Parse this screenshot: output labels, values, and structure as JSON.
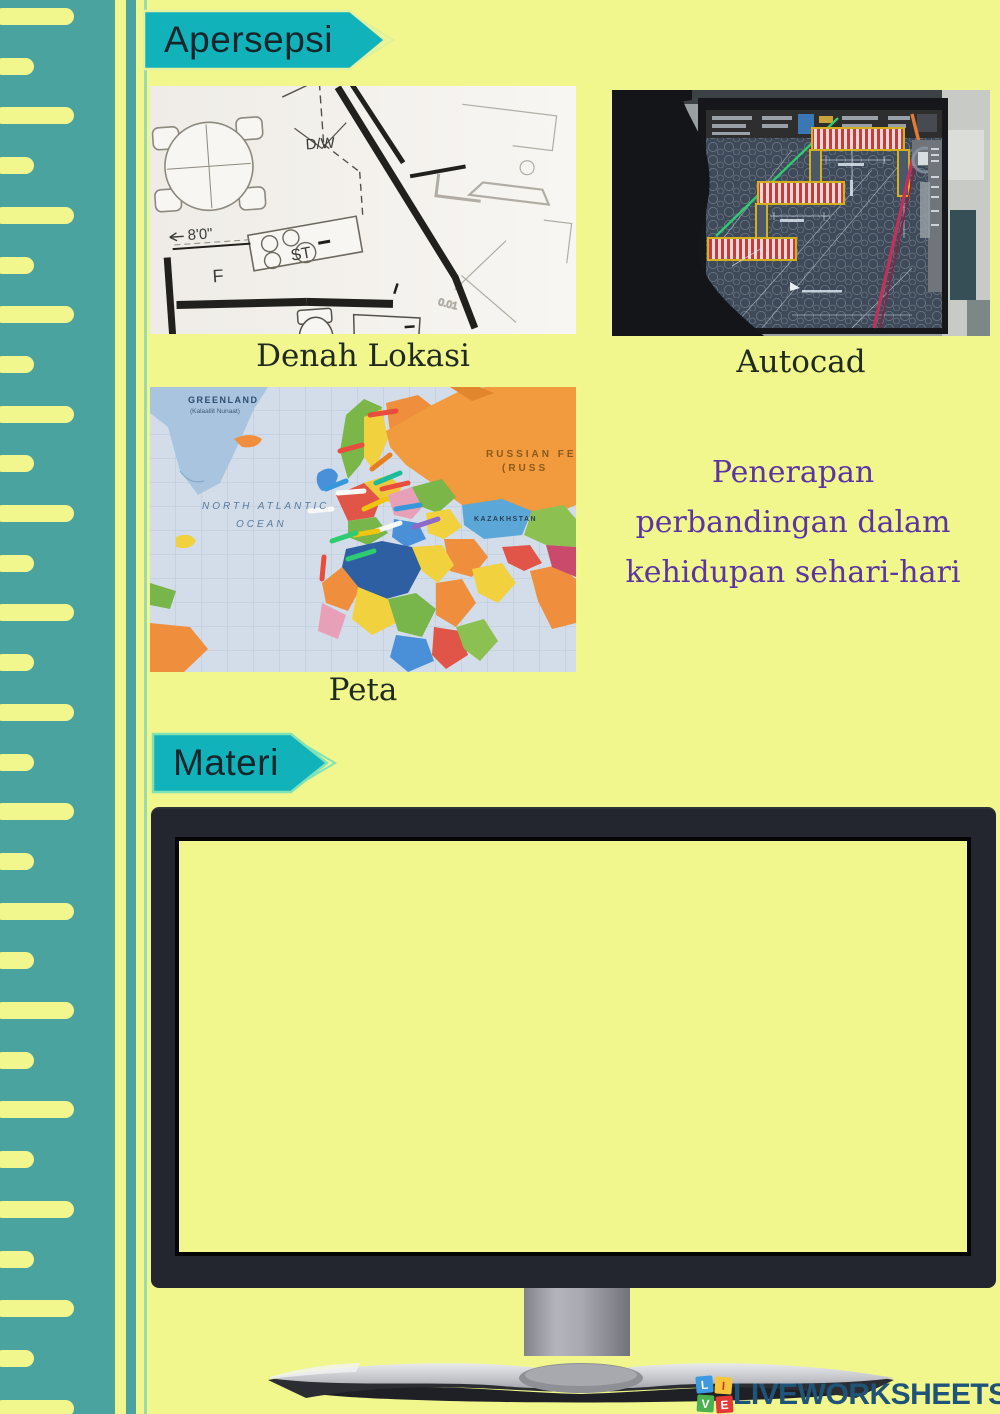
{
  "page": {
    "background": "#f1f78c",
    "sidebar_color": "#4aa39e",
    "accent_teal": "#12b2ba",
    "headline_purple": "#5c35a5"
  },
  "badges": {
    "apersepsi": "Apersepsi",
    "materi": "Materi"
  },
  "figures": {
    "floorplan": {
      "caption": "Denah Lokasi",
      "labels": {
        "dw": "D/W",
        "dim": "8'0\"",
        "f": "F",
        "st": "ST"
      }
    },
    "autocad": {
      "caption": "Autocad"
    },
    "map": {
      "caption": "Peta",
      "labels": {
        "greenland": "GREENLAND",
        "greenland_sub": "(Kalaallit Nunaat)",
        "ocean_line1": "NORTH ATLANTIC",
        "ocean_line2": "OCEAN",
        "russia_line1": "RUSSIAN FE",
        "russia_line2": "(RUSS",
        "kazakhstan": "KAZAKHSTAN"
      }
    }
  },
  "headline": {
    "lines": [
      "Penerapan",
      "perbandingan dalam",
      "kehidupan sehari-hari"
    ]
  },
  "footer": {
    "brand": "LIVEWORKSHEETS",
    "squares": [
      {
        "letter": "L",
        "color": "#3b9ae1"
      },
      {
        "letter": "I",
        "color": "#f5c63c"
      },
      {
        "letter": "V",
        "color": "#4caf50"
      },
      {
        "letter": "E",
        "color": "#e53935"
      }
    ]
  }
}
